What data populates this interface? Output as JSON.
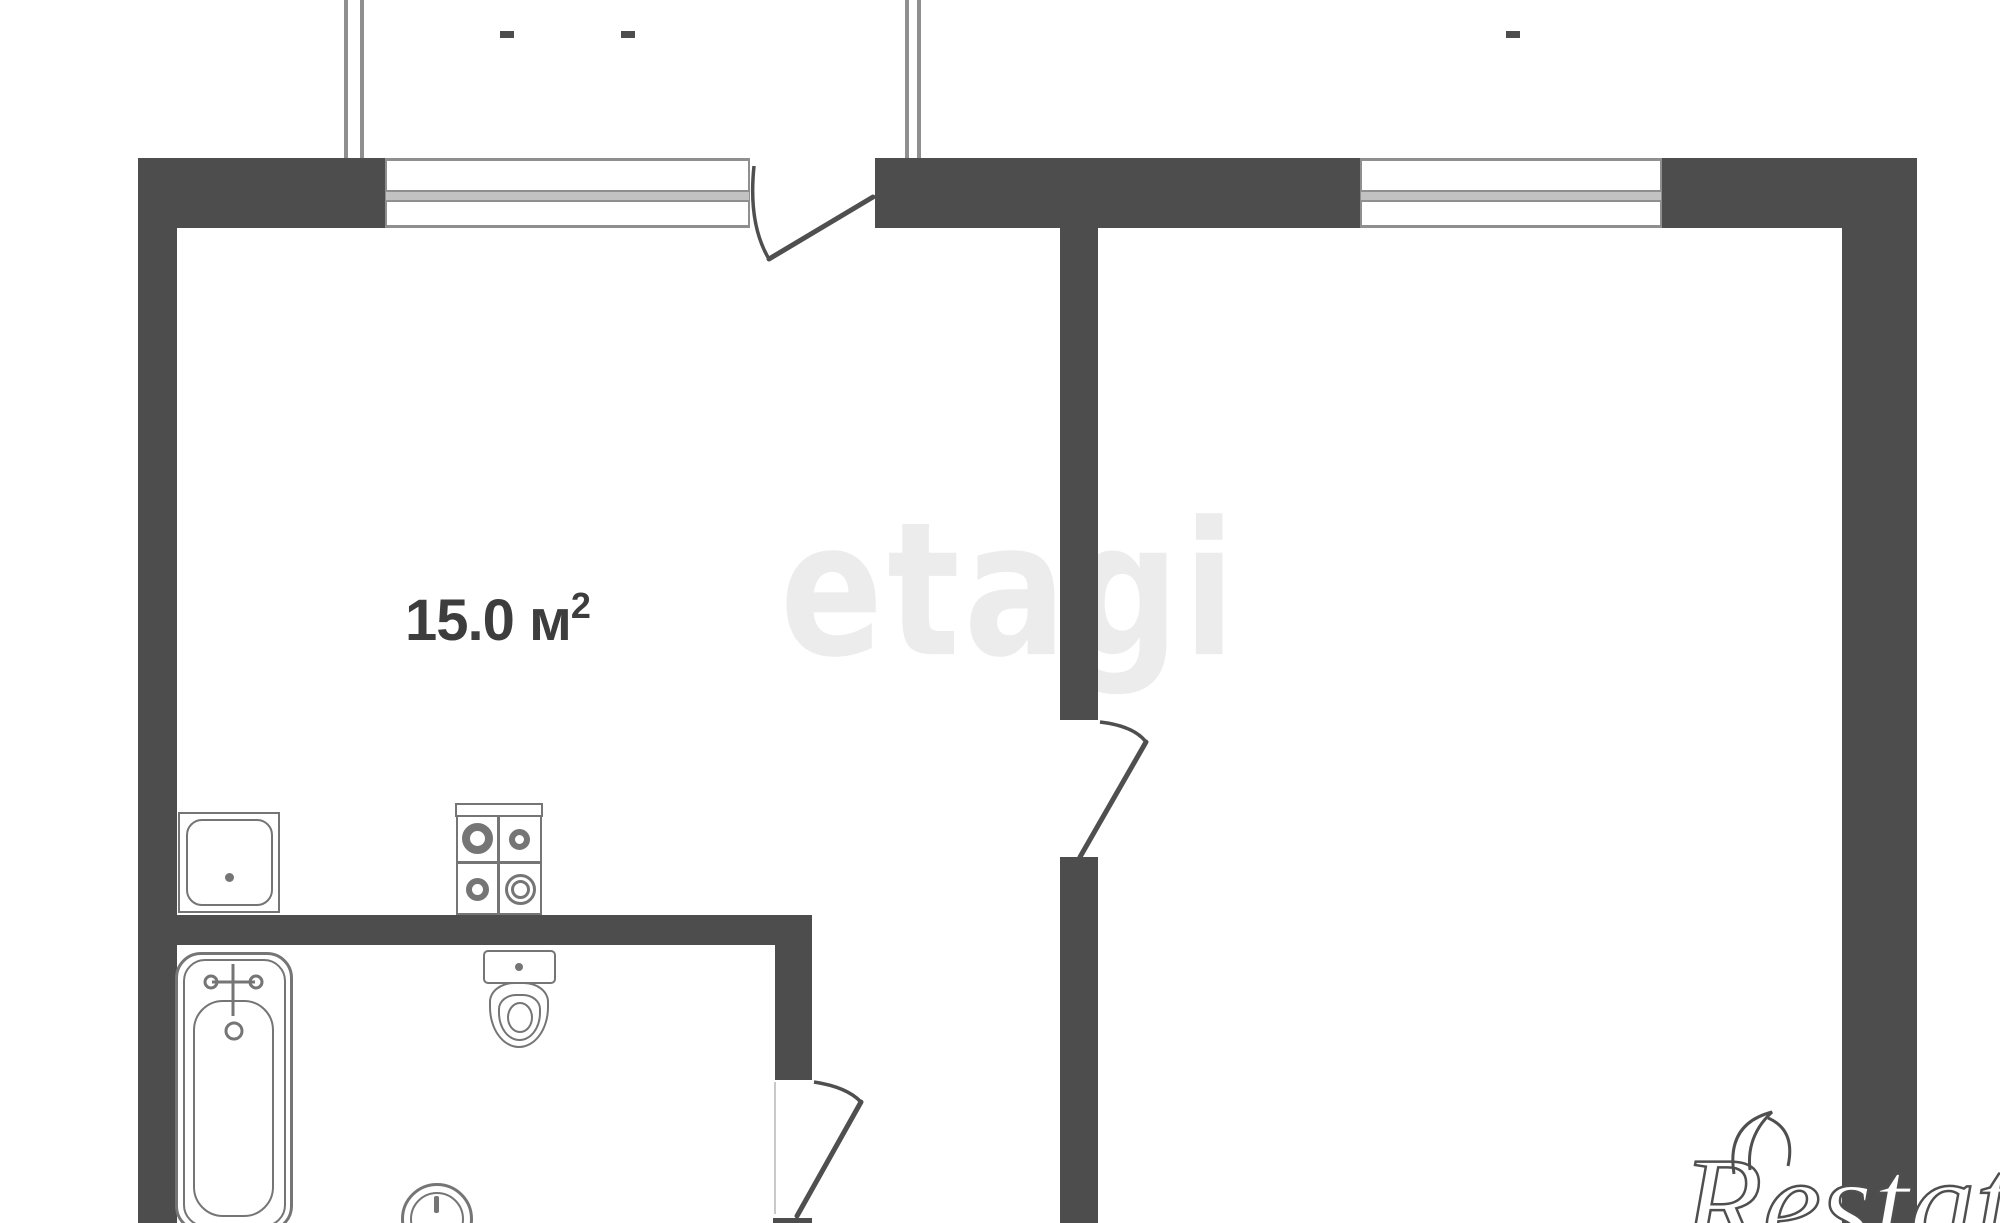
{
  "theme": {
    "background": "#ffffff",
    "wall_color": "#4d4d4d",
    "window_frame_color": "#8f8f8f",
    "window_band_color": "#c2c2c2",
    "fixture_line_color": "#757575",
    "door_line_color": "#4f4f4f",
    "label_color": "#3d3d3d",
    "watermark_center_color": "#ececec",
    "watermark_corner_text_color": "#ffffff",
    "watermark_corner_outline_color": "#4f4f4f"
  },
  "rooms": [
    {
      "id": "kitchen-living-room",
      "area": {
        "value": "15.0",
        "unit": "м",
        "superscript": "2"
      }
    }
  ],
  "fixtures": [
    "kitchen-sink",
    "stove",
    "toilet",
    "bathtub",
    "washing-machine"
  ],
  "watermarks": {
    "center_text": "etagi",
    "corner_text": "Restate"
  }
}
